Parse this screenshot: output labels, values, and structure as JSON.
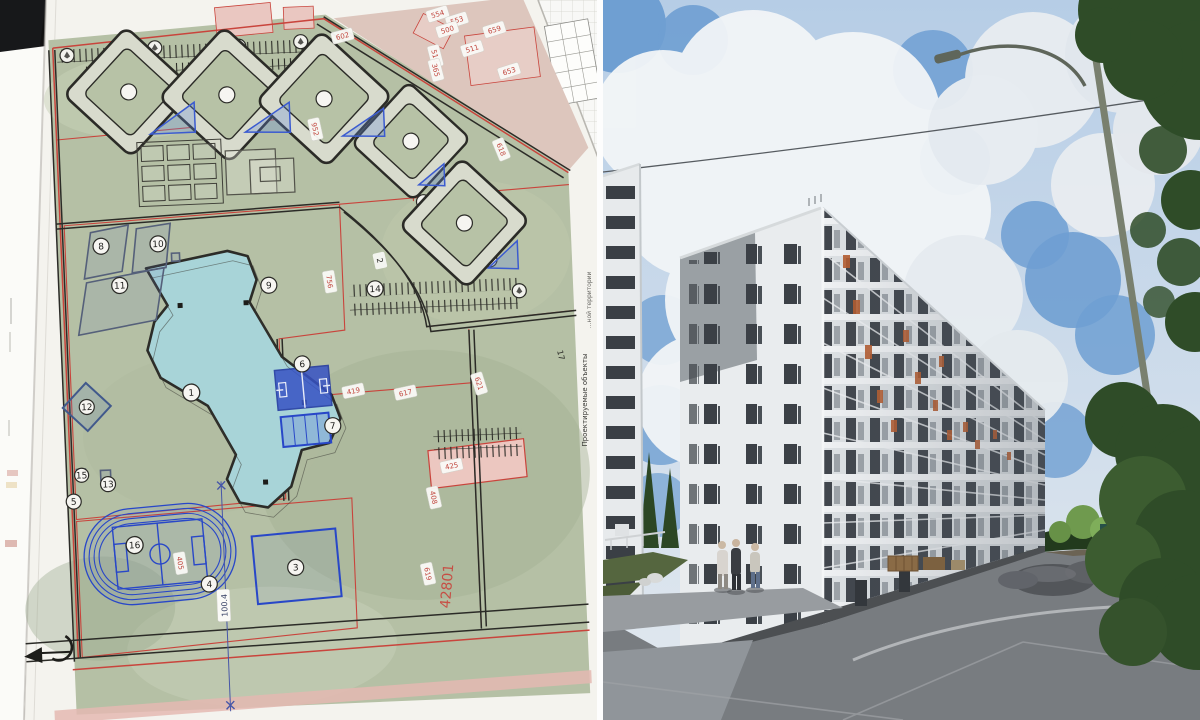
{
  "plan": {
    "markers": [
      "1",
      "3",
      "4",
      "5",
      "6",
      "7",
      "8",
      "9",
      "10",
      "11",
      "12",
      "13",
      "14",
      "15",
      "16"
    ],
    "parcels": [
      "602",
      "554",
      "553",
      "500",
      "659",
      "511",
      "510",
      "365",
      "653",
      "618",
      "952",
      "756",
      "419",
      "621",
      "617",
      "425",
      "408",
      "619",
      "405"
    ],
    "road_labels": [
      "2",
      "17"
    ],
    "dimension": "100.4",
    "area_label": "42801",
    "edge_label_top": "…ной территории",
    "edge_label_bottom": "Проектируемые объекты",
    "colors": {
      "boundary_red": "#c9443c",
      "sports_blue": "#2847c8",
      "school_teal": "#a8d4d8",
      "map_green": "#b5c0a5"
    }
  },
  "photo": {
    "colors": {
      "sky_blue": "#6f9fd2",
      "facade_white": "#e9ecee",
      "balcony_orange": "#b65d30",
      "asphalt": "#787c80"
    }
  }
}
